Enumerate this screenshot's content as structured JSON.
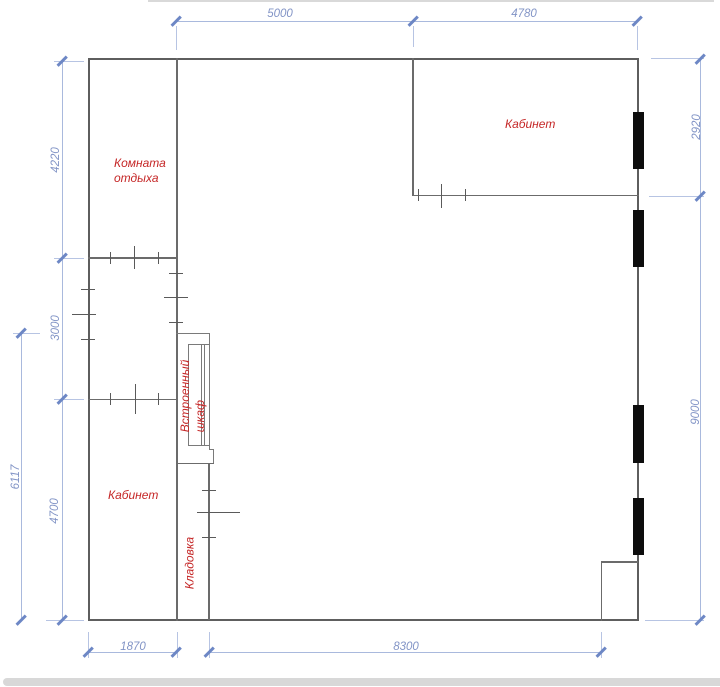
{
  "plan": {
    "rooms": {
      "rest_room_line1": "Комната",
      "rest_room_line2": "отдыха",
      "office_top": "Кабинет",
      "office_bottom": "Кабинет",
      "wardrobe_line1": "Встроенный",
      "wardrobe_line2": "шкаф",
      "storage": "Кладовка"
    },
    "dimensions_mm": {
      "top_span_left": "5000",
      "top_span_right": "4780",
      "right_upper": "2920",
      "right_lower": "9000",
      "left_upper": "4220",
      "left_middle": "3000",
      "left_overall": "6117",
      "left_lower": "4700",
      "bottom_left": "1870",
      "bottom_right": "8300"
    },
    "colors": {
      "dimension_blue": "#8294c6",
      "label_red": "#c52727",
      "wall_gray": "#5e5e5e",
      "radiator_black": "#0d0d0d"
    }
  }
}
